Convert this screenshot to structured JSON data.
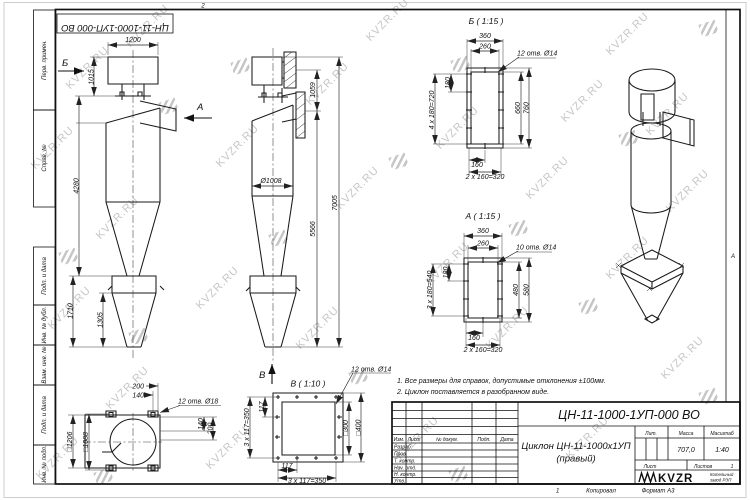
{
  "watermark": {
    "text": "KVZR.RU"
  },
  "sheet": {
    "fold_mark": "2",
    "zone_letter": "А",
    "sheet_no": "1",
    "copied_label": "Копировал",
    "format_label": "Формат А3"
  },
  "stamp_top": {
    "text": "ЦН-11-1000-1УП-000 ВО"
  },
  "margin_labels": {
    "perv_primen": "Перв. примен.",
    "sprav_no": "Справ. №",
    "podp_data_1": "Подп. и дата",
    "inv_dubl": "Инв. № дубл.",
    "vzam_inv": "Взам. инв. №",
    "podp_data_2": "Подп. и дата",
    "inv_podl": "Инв. № подл."
  },
  "notes": {
    "line1": "1. Все размеры для справок, допустимые отклонения ±100мм.",
    "line2": "2. Циклон поставляется в разобранном виде."
  },
  "views": {
    "front": {
      "dim_width": "1200",
      "dim_top": "1015",
      "dim_body": "4280",
      "dim_hopper_full": "1710",
      "dim_hopper": "1305",
      "arrow_b": "Б",
      "arrow_a": "А"
    },
    "side": {
      "dim_dia": "Ø1008",
      "dim_flanges": "1059",
      "dim_mid": "5566",
      "dim_total": "7005",
      "arrow_v": "В"
    },
    "detail_b": {
      "title": "Б ( 1:15 )",
      "holes": "12 отв. Ø14",
      "outer_w": "360",
      "inner_w": "260",
      "pitch": "180",
      "pitch_total": "4 x 180=720",
      "inner_h": "660",
      "outer_h": "760",
      "bottom": "160",
      "bottom_total": "2 x 160=320"
    },
    "detail_a": {
      "title": "А ( 1:15 )",
      "holes": "10 отв. Ø14",
      "outer_w": "360",
      "inner_w": "260",
      "pitch": "180",
      "pitch_total": "3 x 180=540",
      "inner_h": "480",
      "outer_h": "580",
      "bottom": "160",
      "bottom_total": "2 x 160=320"
    },
    "detail_v": {
      "title": "В ( 1:10 )",
      "holes": "12 отв. Ø14",
      "pitch_left": "117",
      "total_left": "3 x 117=350",
      "pitch_bottom": "117",
      "total_bottom": "3 x 117=350",
      "inner_sq": "□300",
      "outer_sq": "□400"
    },
    "top_view": {
      "holes": "12 отв. Ø18",
      "top_200": "200",
      "top_140": "140",
      "right_140": "140",
      "right_200": "200",
      "outer_sq": "□1206",
      "bolt_sq": "□1088"
    }
  },
  "title_block": {
    "doc_number": "ЦН-11-1000-1УП-000 ВО",
    "name_line1": "Циклон ЦН-11-1000х1УП",
    "name_line2": "(правый)",
    "col_izm": "Изм.",
    "col_list": "Лист",
    "col_doc": "№ докум.",
    "col_podp": "Подп.",
    "col_data": "Дата",
    "row_razrab": "Разраб.",
    "row_prov": "Пров.",
    "row_tkontr": "Т. контр.",
    "row_nachotd": "Нач. отд.",
    "row_nkontr": "Н. контр.",
    "row_utv": "Утв.",
    "lit_label": "Лит.",
    "mass_label": "Масса",
    "scale_label": "Масштаб",
    "mass_value": "707,0",
    "scale_value": "1:40",
    "list_label": "Лист",
    "listov_label": "Листов",
    "listov_value": "1",
    "logo_text": "KVZR",
    "logo_sub1": "Котельный",
    "logo_sub2": "завод РЭП"
  }
}
